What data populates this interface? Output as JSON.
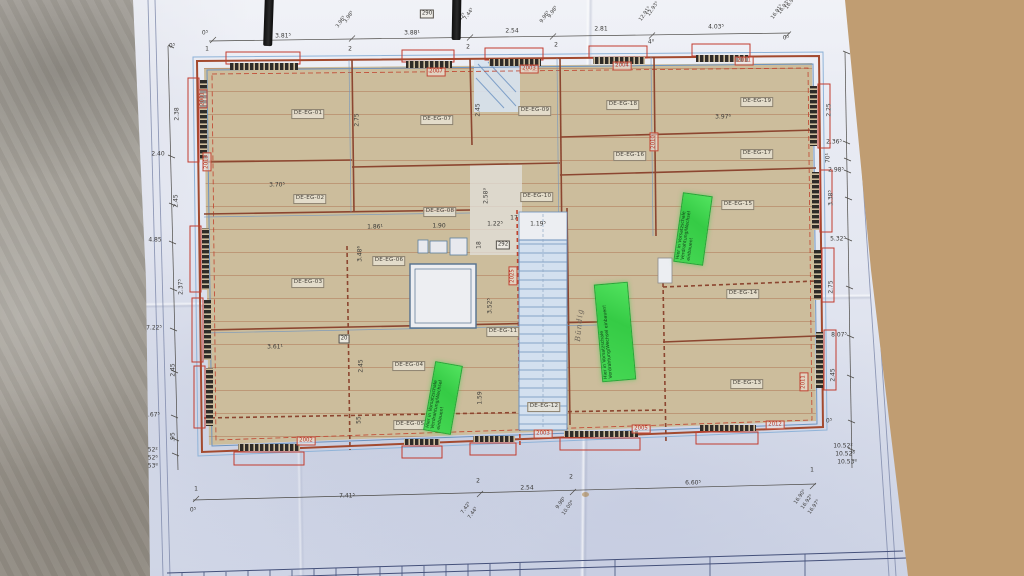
{
  "rooms": [
    "DE-EG-01",
    "DE-EG-02",
    "DE-EG-03",
    "DE-EG-04",
    "DE-EG-05",
    "DE-EG-06",
    "DE-EG-07",
    "DE-EG-08",
    "DE-EG-09",
    "DE-EG-10",
    "DE-EG-11",
    "DE-EG-12",
    "DE-EG-13",
    "DE-EG-14",
    "DE-EG-15",
    "DE-EG-16",
    "DE-EG-17",
    "DE-EG-18",
    "DE-EG-19"
  ],
  "dimensions": {
    "top": [
      "0⁵",
      "3.81⁵",
      "3.88¹",
      "2.54",
      "2.81",
      "4.03⁵",
      "0⁵",
      "3.96⁵",
      "3.98⁵",
      "7.42⁵",
      "7.44⁵",
      "9.96⁵",
      "9.98⁵",
      "12.91⁵",
      "12.93⁵",
      "16.91⁵",
      "16.93⁵",
      "16.96⁵",
      "1",
      "2",
      "2",
      "2",
      "4⁰"
    ],
    "left": [
      "0⁵",
      "2.38",
      "2.40",
      "2.45",
      "4.85",
      "2.37⁵",
      "7.22⁵",
      "2.45",
      "9.67⁵",
      ".95",
      "10.52²",
      "10.52⁶",
      "10.53⁸"
    ],
    "right": [
      "2.25",
      "2.36⁵",
      "70¹",
      "2.98⁵",
      "3.38⁵",
      "5.32⁵",
      "2.75",
      "8.07⁵",
      "2.45",
      "0⁵",
      "10.52²",
      "10.52⁶",
      "10.53⁸"
    ],
    "bottom": [
      "0⁵",
      "1",
      "7.41⁵",
      "2",
      "7.42⁵",
      "7.44⁵",
      "2.54",
      "2",
      "9.98⁵",
      "10.00⁶",
      "6.60⁵",
      "1",
      "16.90⁵",
      "16.92⁵",
      "16.97⁵"
    ],
    "interior": [
      "2.75",
      "3.70⁵",
      "2.45",
      "2.58³",
      "1.86¹",
      "1.90",
      "1.22⁵",
      "17",
      "1.19⁵",
      "3.48⁶",
      "18",
      "3.52⁵",
      "3.61¹",
      "2.45",
      "1.59",
      "3.97⁶",
      "55"
    ]
  },
  "boxed_dimensions": [
    "290",
    "292",
    "20"
  ],
  "window_tags": [
    "2007",
    "2003",
    "2004",
    "2011",
    "2001",
    "2013",
    "2002",
    "2003",
    "2005",
    "2012",
    "2010",
    "2025",
    "2011"
  ],
  "sticky_notes": [
    "Hier in Vorsatzschale Verdrahtung/Wechsel einbauen!",
    "Hier in Vorsatzschale Verdrahtung/Wechsel einbauen!",
    "Hier in Vorsatzschale Verdrahtung/Wechsel einbauen!"
  ],
  "handwritten_note": "Bündig",
  "colors": {
    "panel_beige": "#ccbd9c",
    "wall_red": "#a34a2f",
    "line_blue": "#5d7fae",
    "window_red": "#c23b2e",
    "tag_red": "#b93525",
    "note_green": "#3ed24e",
    "stair_blue": "#6b90bb",
    "paper": "#e6e9f1"
  }
}
